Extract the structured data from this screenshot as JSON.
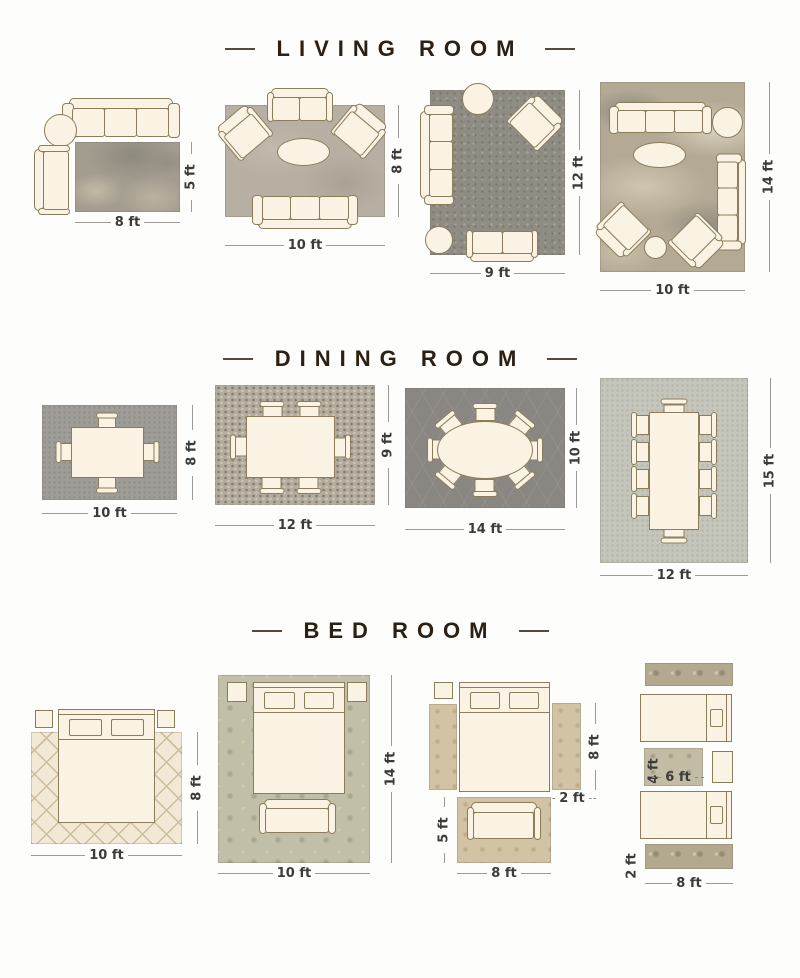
{
  "page": {
    "background": "#fdfdfb"
  },
  "palette": {
    "title_color": "#2b2013",
    "dimension_label_color": "#3b3b3b",
    "dimension_line_color": "#9a9a98",
    "furniture_fill": "#faf3e3",
    "furniture_outline": "#8b7c5c"
  },
  "sections": [
    {
      "title": "LIVING ROOM",
      "layouts": [
        {
          "rug_size": "8 ft x 5 ft",
          "width": "8 ft",
          "height": "5 ft",
          "items": [
            "three-seat-sofa",
            "round-side-table",
            "chaise",
            "mottled-gray-rug"
          ]
        },
        {
          "rug_size": "10 ft x 8 ft",
          "width": "10 ft",
          "height": "8 ft",
          "items": [
            "loveseat",
            "armchair-left",
            "armchair-right",
            "oval-coffee-table",
            "three-seat-sofa",
            "gray-tan-rug"
          ]
        },
        {
          "rug_size": "9 ft x 12 ft",
          "width": "9 ft",
          "height": "12 ft",
          "items": [
            "round-side-table",
            "armchair",
            "three-seat-sofa",
            "round-side-table",
            "loveseat",
            "dark-gray-rug"
          ]
        },
        {
          "rug_size": "10 ft x 14 ft",
          "width": "10 ft",
          "height": "14 ft",
          "items": [
            "three-seat-sofa",
            "round-side-table",
            "oval-coffee-table",
            "three-seat-sofa",
            "armchair",
            "armchair",
            "round-side-table",
            "abstract-tan-rug"
          ]
        }
      ]
    },
    {
      "title": "DINING ROOM",
      "layouts": [
        {
          "rug_size": "10 ft x 8 ft",
          "width": "10 ft",
          "height": "8 ft",
          "items": [
            "square-dining-table",
            "four-chairs",
            "gray-rug"
          ]
        },
        {
          "rug_size": "12 ft x 9 ft",
          "width": "12 ft",
          "height": "9 ft",
          "items": [
            "rectangular-dining-table",
            "six-chairs",
            "mosaic-rug"
          ]
        },
        {
          "rug_size": "14 ft x 10 ft",
          "width": "14 ft",
          "height": "10 ft",
          "items": [
            "oval-dining-table",
            "eight-chairs",
            "trellis-rug"
          ]
        },
        {
          "rug_size": "12 ft x 15 ft",
          "width": "12 ft",
          "height": "15 ft",
          "items": [
            "rectangular-dining-table",
            "ten-chairs",
            "sage-rug"
          ]
        }
      ]
    },
    {
      "title": "BED ROOM",
      "layouts": [
        {
          "rug_size": "10 ft x 8 ft",
          "width": "10 ft",
          "height": "8 ft",
          "items": [
            "queen-bed",
            "two-nightstands",
            "cream-diamond-rug"
          ]
        },
        {
          "rug_size": "10 ft x 14 ft",
          "width": "10 ft",
          "height": "14 ft",
          "items": [
            "queen-bed",
            "two-nightstands",
            "bench",
            "sage-damask-rug"
          ]
        },
        {
          "runner_height": "8 ft",
          "runner_width": "2 ft",
          "foot_rug_height": "5 ft",
          "foot_rug_width": "8 ft",
          "items": [
            "queen-bed",
            "two-nightstands",
            "two-runner-rugs",
            "foot-rug",
            "bench"
          ]
        },
        {
          "middle_rug_height": "4 ft",
          "middle_rug_width": "6 ft",
          "runner_height": "2 ft",
          "runner_width": "8 ft",
          "items": [
            "two-twin-beds",
            "nightstand",
            "two-runner-rugs",
            "middle-rug"
          ]
        }
      ]
    }
  ]
}
